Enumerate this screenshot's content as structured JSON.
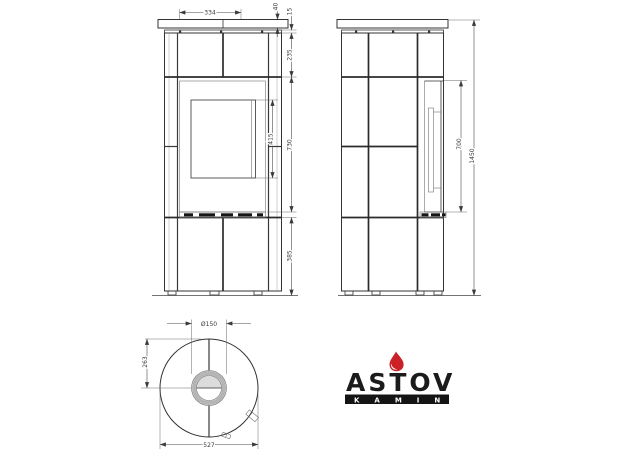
{
  "title": "ASTOV KAMIN stove technical drawing (front, side and top views)",
  "dims": {
    "front": {
      "top_width": "334",
      "plate_height": "40",
      "rim_height": "15",
      "top_band_height": "235",
      "glass_height": "415",
      "door_height": "730",
      "base_height": "385"
    },
    "side": {
      "door_height": "700",
      "total_height": "1450"
    },
    "top": {
      "flue_diameter": "Ø150",
      "flue_center_offset": "263",
      "body_diameter": "527"
    }
  },
  "logo": {
    "brand": "ASTOV",
    "subbrand": "KAMIN",
    "text_color": "#1b1b1b",
    "flame_color": "#cb2026",
    "bar_color": "#141414",
    "subbrand_color": "#ffffff"
  },
  "style": {
    "background": "#ffffff",
    "line_color": "#333333",
    "dim_color": "#4a4a4a"
  }
}
